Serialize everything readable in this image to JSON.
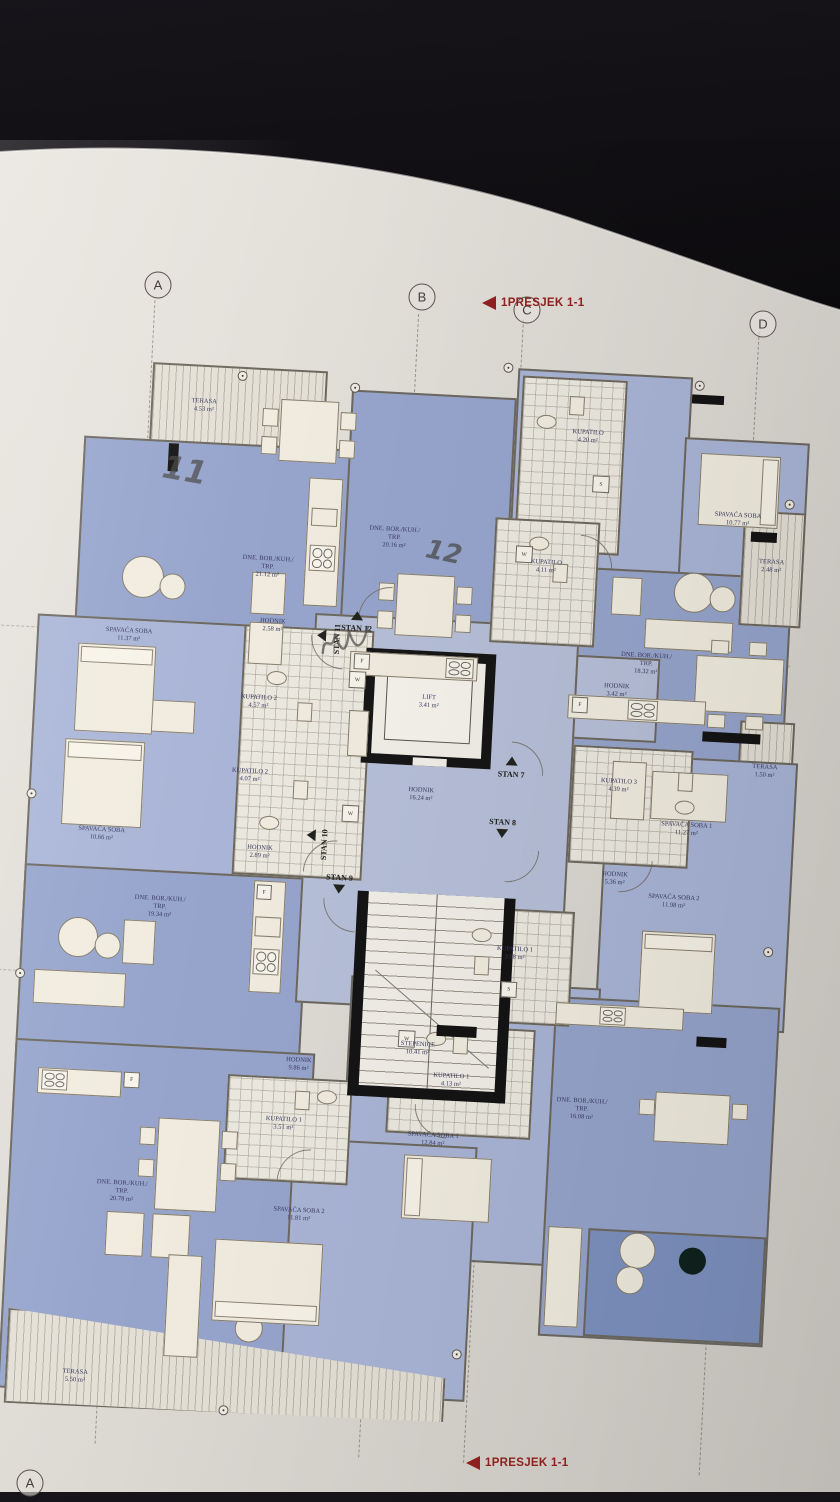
{
  "drawing": {
    "type": "architectural floor plan photo",
    "section_label_top": "1PRESJEK 1-1",
    "section_label_bottom": "1PRESJEK 1-1",
    "grid_letters": [
      "A",
      "B",
      "C",
      "D"
    ],
    "grid_letter_bottom": "A"
  },
  "colors": {
    "background": "#0a090b",
    "paper": "#e2ded8",
    "room_blue": "#97a5cd",
    "room_blue_light": "#aab5d7",
    "room_blue_dark": "#7e92c0",
    "wall": "#6e695f",
    "core_wall": "#161616",
    "section_red": "#8e2020",
    "label_ink": "#3a3a5e"
  },
  "rooms": [
    {
      "name": "TERASA",
      "area": "4.53 m²"
    },
    {
      "name": "DNE. BOR./KUH./ TRP.",
      "area": "21.12 m²"
    },
    {
      "name": "SPAVAĆA SOBA",
      "area": "11.37 m²"
    },
    {
      "name": "SPAVAĆA SOBA",
      "area": "10.66 m²"
    },
    {
      "name": "HODNIK",
      "area": "2.58 m²"
    },
    {
      "name": "KUPATILO 2",
      "area": "4.57 m²"
    },
    {
      "name": "KUPATILO 2",
      "area": "4.07 m²"
    },
    {
      "name": "HODNIK",
      "area": "2.89 m²"
    },
    {
      "name": "DNE. BOR./KUH./ TRP.",
      "area": "19.34 m²"
    },
    {
      "name": "DNE. BOR./KUH./ TRP.",
      "area": "20.16 m²"
    },
    {
      "name": "LIFT",
      "area": "3.41 m²"
    },
    {
      "name": "HODNIK",
      "area": "16.24 m²"
    },
    {
      "name": "HODNIK",
      "area": "3.42 m²"
    },
    {
      "name": "KUPATILO",
      "area": "4.20 m²"
    },
    {
      "name": "KUPATILO",
      "area": "4.11 m²"
    },
    {
      "name": "SPAVAĆA SOBA",
      "area": "10.77 m²"
    },
    {
      "name": "DNE. BOR./KUH./ TRP.",
      "area": "18.32 m²"
    },
    {
      "name": "TERASA",
      "area": "2.48 m²"
    },
    {
      "name": "TERASA",
      "area": "1.50 m²"
    },
    {
      "name": "KUPATILO 3",
      "area": "4.39 m²"
    },
    {
      "name": "SPAVAĆA SOBA 1",
      "area": "11.27 m²"
    },
    {
      "name": "HODNIK",
      "area": "5.36 m²"
    },
    {
      "name": "SPAVAĆA SOBA 2",
      "area": "11.98 m²"
    },
    {
      "name": "STEPENICE",
      "area": "10.41 m²"
    },
    {
      "name": "KUPATILO 1",
      "area": "3.08 m²"
    },
    {
      "name": "HODNIK",
      "area": "9.86 m²"
    },
    {
      "name": "KUPATILO 1",
      "area": "4.13 m²"
    },
    {
      "name": "SPAVAĆA SOBA 1",
      "area": "12.84 m²"
    },
    {
      "name": "DNE. BOR./KUH./ TRP.",
      "area": "16.08 m²"
    },
    {
      "name": "DNE. BOR./KUH./ TRP.",
      "area": "20.78 m²"
    },
    {
      "name": "KUPATILO 1",
      "area": "3.51 m²"
    },
    {
      "name": "SPAVAĆA SOBA 2",
      "area": "11.81 m²"
    },
    {
      "name": "TERASA",
      "area": "5.50 m²"
    }
  ],
  "stans": [
    "STAN 12",
    "STAN 11",
    "STAN 10",
    "STAN 9",
    "STAN 8",
    "STAN 7"
  ],
  "fixtures": {
    "fridge": "F",
    "washer": "W",
    "dryer": "S"
  },
  "annotations": {
    "handwritten_1": "11",
    "handwritten_2": "12"
  }
}
